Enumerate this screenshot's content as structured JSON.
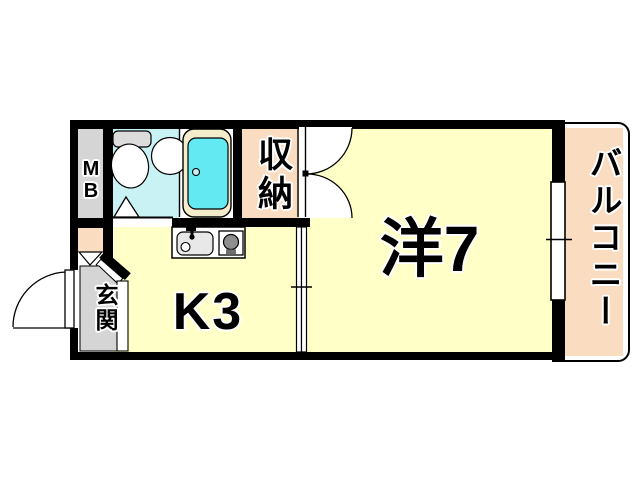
{
  "plan": {
    "type": "japanese-apartment-floorplan",
    "layout": "1K",
    "labels": {
      "western_room": "洋7",
      "kitchen": "K3",
      "storage": "収納",
      "balcony": "バルコニー",
      "entrance": "玄関",
      "meter_box": "MB"
    },
    "rooms": [
      {
        "name": "western_room",
        "label": "洋7",
        "size_mats": 7
      },
      {
        "name": "kitchen",
        "label": "K3",
        "size_mats": 3
      },
      {
        "name": "storage",
        "label": "収納"
      },
      {
        "name": "balcony",
        "label": "バルコニー"
      },
      {
        "name": "entrance",
        "label": "玄関"
      },
      {
        "name": "meter_box",
        "label": "MB"
      }
    ],
    "fixtures": [
      "toilet",
      "wash-basin",
      "bathtub",
      "bath-folding-door",
      "entrance-swing-door",
      "closet-double-doors",
      "sliding-door",
      "sliding-window",
      "kitchen-sink",
      "gas-stove"
    ],
    "colors": {
      "wall": "#000000",
      "room_fill": "#ffffc8",
      "balcony_fill": "#fadcc0",
      "bath_floor": "#c8f2f4",
      "bathtub_water": "#63e9f2",
      "bathtub_rim": "#f3edcc",
      "gray_area": "#d5d5d5"
    }
  }
}
